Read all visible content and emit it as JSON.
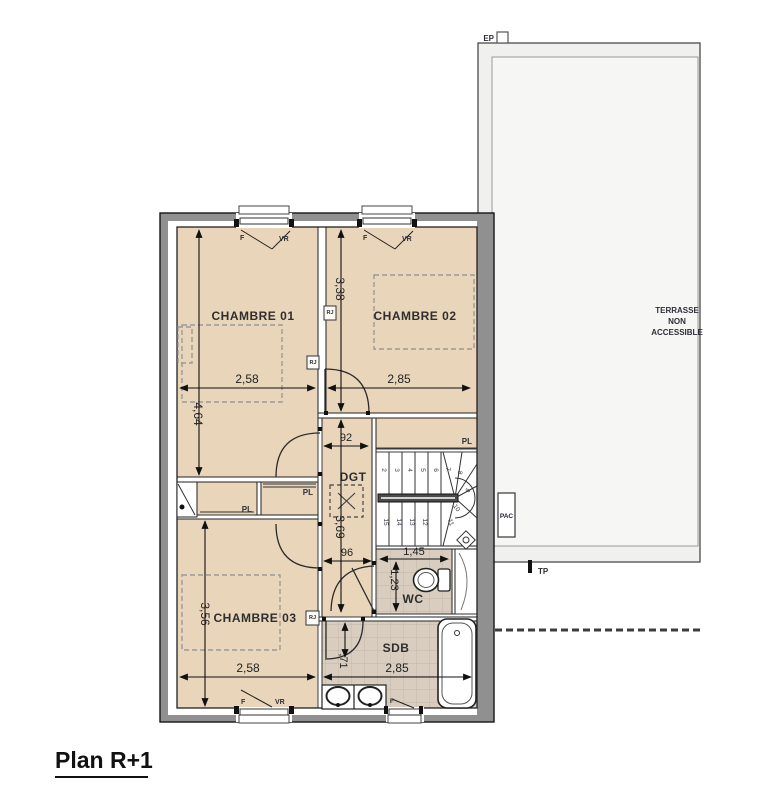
{
  "title": "Plan R+1",
  "rooms": {
    "chambre1": "CHAMBRE 01",
    "chambre2": "CHAMBRE 02",
    "chambre3": "CHAMBRE 03",
    "degagement": "DGT",
    "wc": "WC",
    "sdb": "SDB"
  },
  "terrace": {
    "line1": "TERRASSE",
    "line2": "NON",
    "line3": "ACCESSIBLE"
  },
  "labels": {
    "placard": "PL",
    "pac": "PAC",
    "ep": "EP",
    "tp": "TP",
    "fenetre": "F",
    "volet_roulant": "VR",
    "rj": "RJ"
  },
  "dimensions": {
    "chambre1_width": "2,58",
    "chambre2_width": "2,85",
    "chambre1_depth": "4,64",
    "chambre2_depth": "3,38",
    "dgt_width": "92",
    "dgt_depth": "3,69",
    "dgt_width_lower": "96",
    "wc_width": "1,45",
    "wc_depth": "1,23",
    "chambre3_depth": "3,56",
    "chambre3_width": "2,58",
    "sdb_width": "2,85",
    "sdb_door_width": ",71"
  },
  "stairs": {
    "steps": [
      "2",
      "3",
      "4",
      "5",
      "6",
      "7",
      "8",
      "9",
      "10",
      "11",
      "12",
      "13",
      "14",
      "15"
    ]
  },
  "colors": {
    "room_fill": "#e9d5ba",
    "tile_fill": "#d8cdbf",
    "wall_fill": "#909090",
    "terrace_fill": "#f0f0ef",
    "line": "#1c1c1c"
  }
}
